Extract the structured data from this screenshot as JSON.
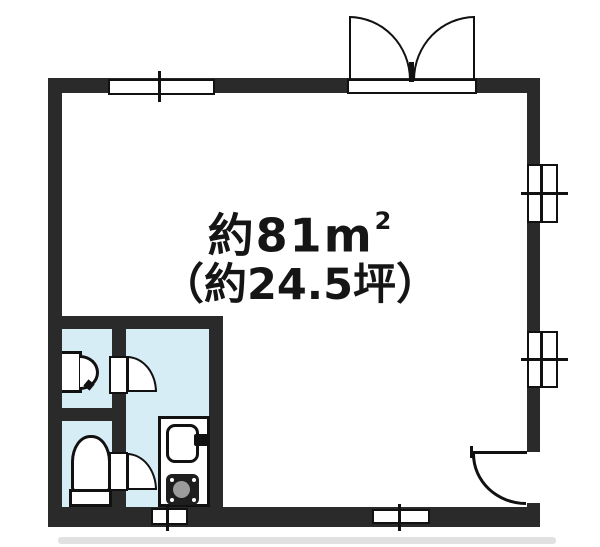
{
  "labels": {
    "area_value": "約81",
    "area_unit_base": "m",
    "area_unit_sup": "2",
    "area_tsubo": "（約24.5坪）"
  },
  "colors": {
    "wall": "#2a2a2a",
    "line": "#111111",
    "wet_area_fill": "#d6edf6",
    "stove_body": "#1e1e1e",
    "stove_burner": "#9b9b9b",
    "paper": "#ffffff",
    "scan_shadow": "#c4c4c4"
  },
  "symbols": {
    "entry": "double-swing-door-icon",
    "right_wall_door": "single-swing-door-icon",
    "interior_doors": "single-swing-door-icon",
    "windows": "sliding-window-icon",
    "fixtures": [
      "washbasin-icon",
      "toilet-icon",
      "kitchen-sink-icon",
      "stove-icon"
    ]
  }
}
